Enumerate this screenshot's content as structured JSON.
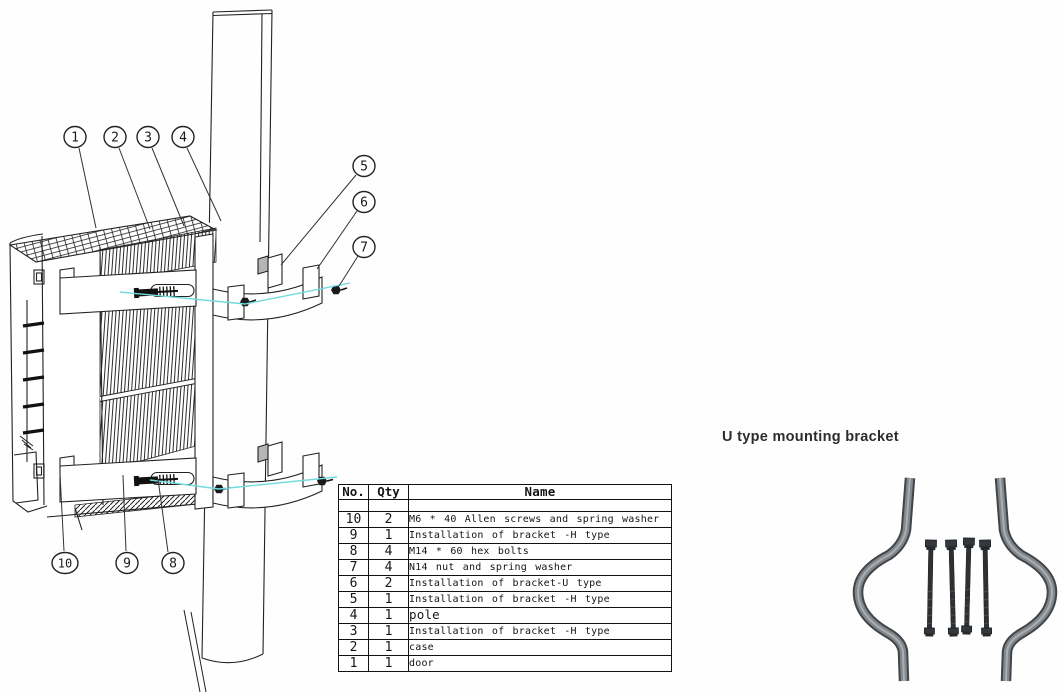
{
  "u_bracket_panel": {
    "title": "U type mounting bracket"
  },
  "diagram": {
    "callouts": [
      "1",
      "2",
      "3",
      "4",
      "5",
      "6",
      "7",
      "8",
      "9",
      "10"
    ],
    "assembly_line_color": "#6fd9dd",
    "line_color": "#222222",
    "bracket_metal_color": "#82878c",
    "bolt_color": "#2e3134"
  },
  "parts_table": {
    "headers": {
      "no": "No.",
      "qty": "Qty",
      "name": "Name"
    },
    "rows": [
      {
        "no": "10",
        "qty": "2",
        "name": "M6 * 40 Allen screws and spring washer"
      },
      {
        "no": "9",
        "qty": "1",
        "name": "Installation of bracket -H type"
      },
      {
        "no": "8",
        "qty": "4",
        "name": "M14 * 60 hex bolts"
      },
      {
        "no": "7",
        "qty": "4",
        "name": "N14 nut and spring washer"
      },
      {
        "no": "6",
        "qty": "2",
        "name": "Installation of bracket-U type"
      },
      {
        "no": "5",
        "qty": "1",
        "name": "Installation of bracket -H type"
      },
      {
        "no": "4",
        "qty": "1",
        "name": "pole"
      },
      {
        "no": "3",
        "qty": "1",
        "name": "Installation of bracket -H type"
      },
      {
        "no": "2",
        "qty": "1",
        "name": "case"
      },
      {
        "no": "1",
        "qty": "1",
        "name": "door"
      }
    ]
  }
}
